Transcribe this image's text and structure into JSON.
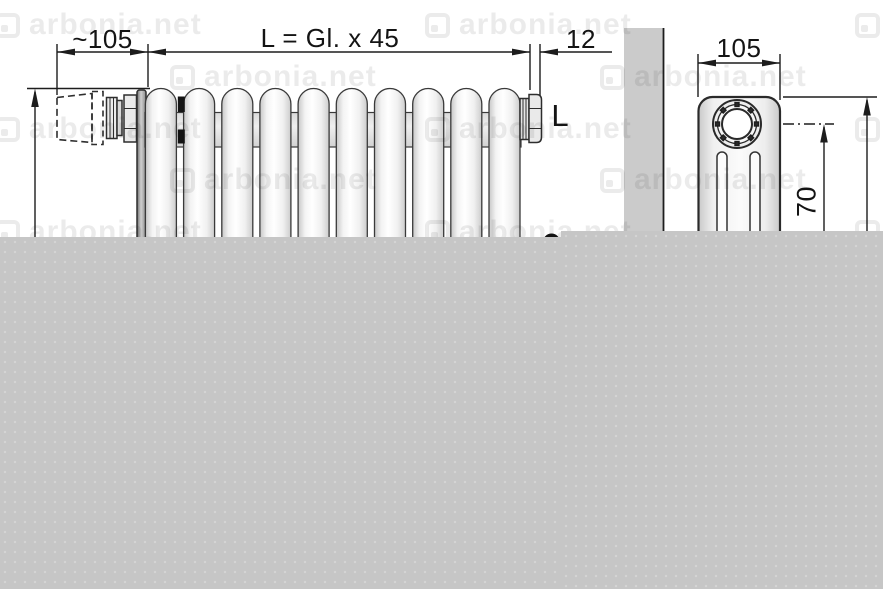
{
  "drawing": {
    "title": "radiator-dimension-drawing",
    "front_view": {
      "dim_valve_width": "~105",
      "dim_length_formula": "L = Gl. x 45",
      "dim_end_plug": "12",
      "length_label": "L"
    },
    "side_view": {
      "dim_depth": "105",
      "dim_pipe_center_height": "70"
    }
  },
  "watermark": {
    "text": "arbonia.net",
    "logo": "arbonia-logo"
  },
  "colors": {
    "line": "#1d1d1d",
    "outline": "#2e2e2e",
    "wall_gray": "#cbcbcb",
    "bottom_gray": "#c6c6c6",
    "radiator_white": "#fbfbfb",
    "nipple_black": "#141414"
  }
}
